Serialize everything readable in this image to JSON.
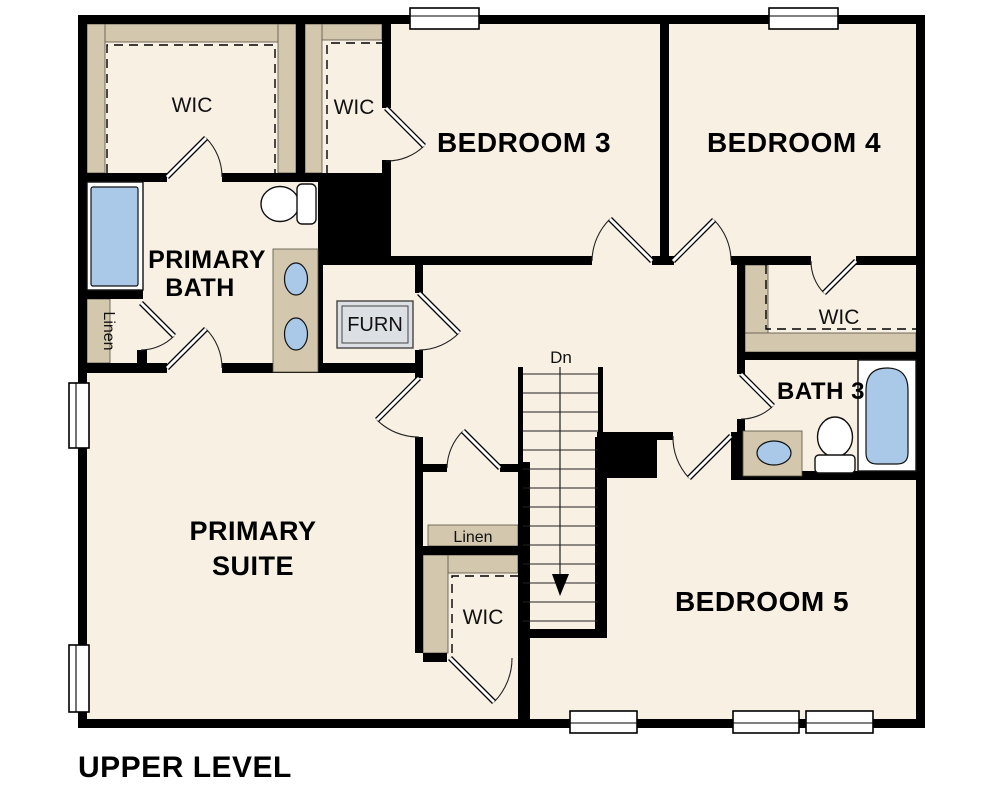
{
  "title": "UPPER LEVEL",
  "colors": {
    "page_bg": "#ffffff",
    "wall": "#000000",
    "floor": "#f8f0e3",
    "closet": "#d3c7ae",
    "fixture_blue": "#aac9e8",
    "fixture_white": "#ffffff",
    "furnace_fill": "#dce0e4"
  },
  "rooms": {
    "wic_top_left": "WIC",
    "wic_top_mid": "WIC",
    "bedroom_3": "BEDROOM 3",
    "bedroom_4": "BEDROOM 4",
    "primary_bath": [
      "PRIMARY",
      "BATH"
    ],
    "wic_right": "WIC",
    "bath_3": "BATH 3",
    "primary_suite": [
      "PRIMARY",
      "SUITE"
    ],
    "bedroom_5": "BEDROOM 5",
    "wic_lower": "WIC",
    "linen_left": "Linen",
    "linen_center": "Linen",
    "furnace": "FURN"
  },
  "stairs": {
    "direction_label": "Dn"
  }
}
